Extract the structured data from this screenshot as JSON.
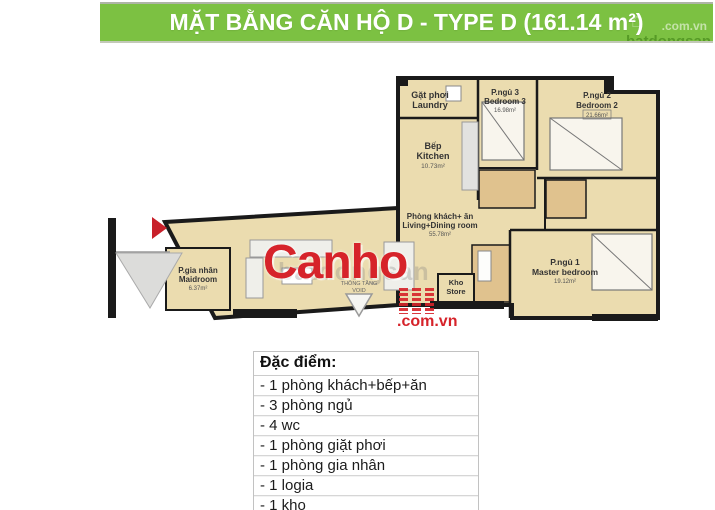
{
  "banner": {
    "title": "MẶT BẰNG CĂN HỘ D - TYPE D (161.14 m²)",
    "corner_watermark_top": ".com.vn",
    "corner_watermark_bottom": "batdongsan",
    "bg_color": "#7CC142",
    "house_icon": "⌂"
  },
  "watermarks": {
    "logo_text": "Canho",
    "logo_suffix": ".com.vn",
    "faint_text": "batdongsan",
    "logo_color": "#D6232A"
  },
  "floorplan": {
    "colors": {
      "floor": "#EBDCAF",
      "wall": "#1A1A1A",
      "bath": "#E0C28E",
      "accent_red": "#C8202A"
    },
    "rooms": {
      "laundry": {
        "vi": "Gặt phơi",
        "en": "Laundry"
      },
      "kitchen": {
        "vi": "Bếp",
        "en": "Kitchen",
        "area": "10.73m²"
      },
      "bedroom3": {
        "vi": "P.ngủ 3",
        "en": "Bedroom 3",
        "area": "16.98m²"
      },
      "bedroom2": {
        "vi": "P.ngủ 2",
        "en": "Bedroom 2",
        "area": "21.66m²"
      },
      "living": {
        "vi": "Phòng khách+ ăn",
        "en": "Living+Dining room",
        "area": "55.78m²"
      },
      "maid": {
        "vi": "P.gia nhân",
        "en": "Maidroom",
        "area": "6.37m²"
      },
      "store": {
        "vi": "Kho",
        "en": "Store"
      },
      "master": {
        "vi": "P.ngủ 1",
        "en": "Master bedroom",
        "area": "19.12m²"
      },
      "void": {
        "vi": "THÔNG TẦNG",
        "en": "VOID"
      }
    }
  },
  "features": {
    "header": "Đặc điểm:",
    "items": [
      "- 1 phòng khách+bếp+ăn",
      "- 3 phòng ngủ",
      "- 4 wc",
      "- 1 phòng giặt phơi",
      "- 1 phòng gia nhân",
      "- 1 logia",
      "- 1 kho"
    ]
  }
}
